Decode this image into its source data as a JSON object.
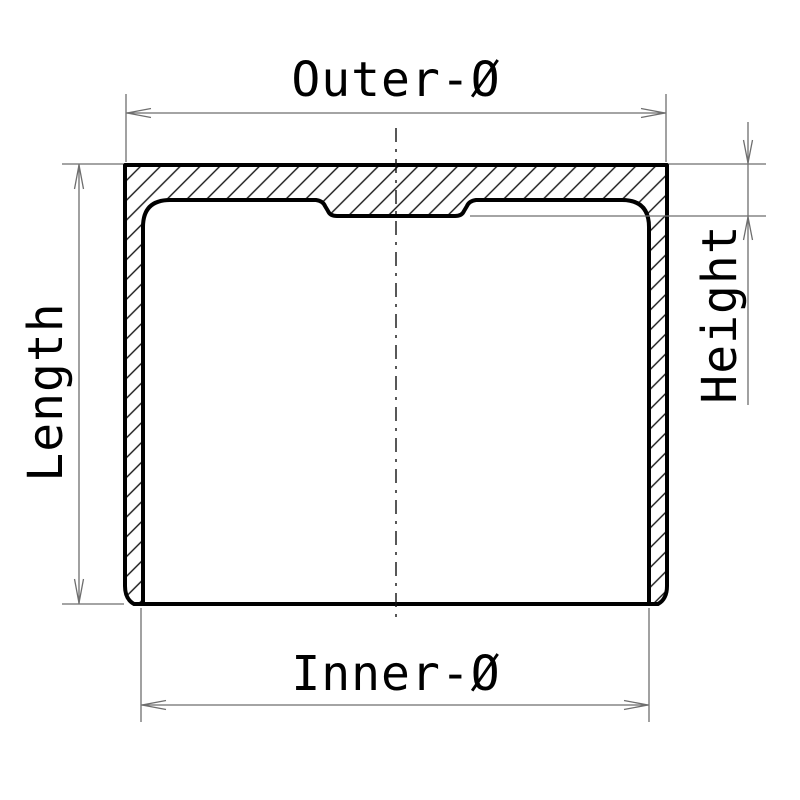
{
  "drawing": {
    "description": "Technical cross-section drawing of a cup-shaped tappet with dimension annotations",
    "labels": {
      "outer_diameter": "Outer-Ø",
      "inner_diameter": "Inner-Ø",
      "length": "Length",
      "height": "Height"
    },
    "colors": {
      "background": "#ffffff",
      "outline": "#000000",
      "hatch": "#161616",
      "dimension_lines": "#6e6e6e",
      "text": "#000000"
    }
  }
}
